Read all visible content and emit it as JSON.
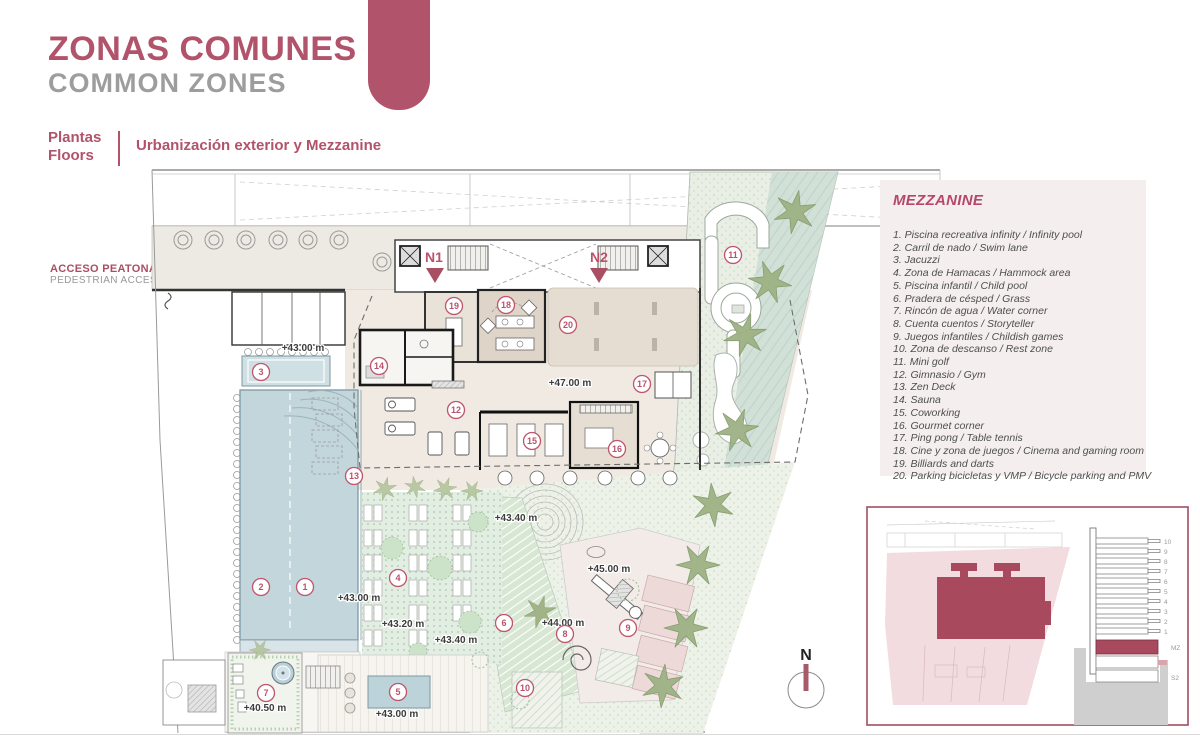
{
  "header": {
    "title": "ZONAS COMUNES",
    "subtitle": "COMMON ZONES",
    "section_label_line1": "Plantas",
    "section_label_line2": "Floors",
    "section_title": "Urbanización exterior y Mezzanine"
  },
  "access": {
    "line1": "ACCESO PEATONAL",
    "line2": "PEDESTRIAN ACCESS"
  },
  "legend": {
    "title": "MEZZANINE",
    "items": [
      "1. Piscina recreativa infinity / Infinity pool",
      "2. Carril de nado / Swim lane",
      "3. Jacuzzi",
      "4. Zona de Hamacas / Hammock area",
      "5. Piscina infantil / Child pool",
      "6. Pradera de césped / Grass",
      "7. Rincón de agua / Water corner",
      "8. Cuenta cuentos / Storyteller",
      "9. Juegos infantiles / Childish games",
      "10. Zona de descanso / Rest zone",
      "11. Mini golf",
      "12. Gimnasio / Gym",
      "13. Zen Deck",
      "14. Sauna",
      "15. Coworking",
      "16. Gourmet corner",
      "17. Ping pong / Table tennis",
      "18. Cine y zona de juegos / Cinema and gaming room",
      "19. Billiards and darts",
      "20. Parking bicicletas y VMP / Bicycle parking and PMV"
    ]
  },
  "plan": {
    "north_label": "N",
    "cores": [
      {
        "label": "N1"
      },
      {
        "label": "N2"
      }
    ],
    "levels": [
      {
        "text": "+43.00 m",
        "x": 303,
        "y": 348
      },
      {
        "text": "+47.00 m",
        "x": 570,
        "y": 383
      },
      {
        "text": "+43.40 m",
        "x": 516,
        "y": 518
      },
      {
        "text": "+43.00 m",
        "x": 359,
        "y": 598
      },
      {
        "text": "+43.20 m",
        "x": 403,
        "y": 624
      },
      {
        "text": "+43.40 m",
        "x": 456,
        "y": 640
      },
      {
        "text": "+45.00 m",
        "x": 609,
        "y": 569
      },
      {
        "text": "+44.00 m",
        "x": 563,
        "y": 623
      },
      {
        "text": "+40.50 m",
        "x": 265,
        "y": 708
      },
      {
        "text": "+43.00 m",
        "x": 397,
        "y": 714
      }
    ],
    "markers": [
      {
        "n": "1",
        "x": 305,
        "y": 587
      },
      {
        "n": "2",
        "x": 261,
        "y": 587
      },
      {
        "n": "3",
        "x": 261,
        "y": 372
      },
      {
        "n": "4",
        "x": 398,
        "y": 578
      },
      {
        "n": "5",
        "x": 398,
        "y": 692
      },
      {
        "n": "6",
        "x": 504,
        "y": 623
      },
      {
        "n": "7",
        "x": 266,
        "y": 693
      },
      {
        "n": "8",
        "x": 565,
        "y": 634
      },
      {
        "n": "9",
        "x": 628,
        "y": 628
      },
      {
        "n": "10",
        "x": 525,
        "y": 688
      },
      {
        "n": "11",
        "x": 733,
        "y": 255
      },
      {
        "n": "12",
        "x": 456,
        "y": 410
      },
      {
        "n": "13",
        "x": 354,
        "y": 476
      },
      {
        "n": "14",
        "x": 379,
        "y": 366
      },
      {
        "n": "15",
        "x": 532,
        "y": 441
      },
      {
        "n": "16",
        "x": 617,
        "y": 449
      },
      {
        "n": "17",
        "x": 642,
        "y": 384
      },
      {
        "n": "18",
        "x": 506,
        "y": 305
      },
      {
        "n": "19",
        "x": 454,
        "y": 306
      },
      {
        "n": "20",
        "x": 568,
        "y": 325
      }
    ]
  },
  "inset": {
    "floors": [
      "10",
      "9",
      "8",
      "7",
      "6",
      "5",
      "4",
      "3",
      "2",
      "1",
      "MZ",
      "S2"
    ]
  },
  "colors": {
    "accent": "#b1536a",
    "accent_dark": "#a8495e",
    "gray_text": "#9d9d9d",
    "pool_blue": "#c2d6dc",
    "terrace_beige": "#f0eae3",
    "garden_green": "#dfe9dc",
    "tree_green": "#9db184",
    "legend_bg": "#f4eeee"
  }
}
